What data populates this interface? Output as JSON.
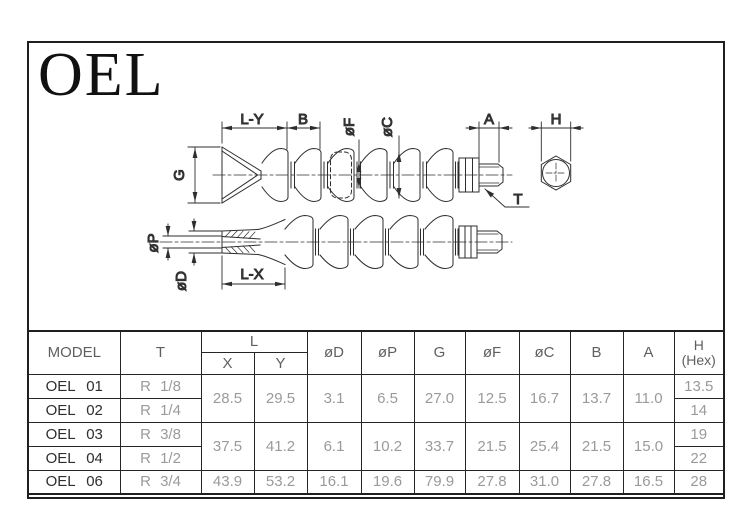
{
  "title": "OEL",
  "drawing": {
    "labels": {
      "ly": "L-Y",
      "b": "B",
      "of": "øF",
      "oc": "øC",
      "a": "A",
      "h": "H",
      "g": "G",
      "t": "T",
      "op": "øP",
      "od": "øD",
      "lx": "L-X"
    }
  },
  "table": {
    "headers": {
      "model": "MODEL",
      "t": "T",
      "l": "L",
      "x": "X",
      "y": "Y",
      "od": "øD",
      "op": "øP",
      "g": "G",
      "of": "øF",
      "oc": "øC",
      "b": "B",
      "a": "A",
      "h1": "H",
      "h2": "(Hex)"
    },
    "rows": [
      {
        "model": "OEL 01",
        "t": "R 1/8",
        "h": "13.5"
      },
      {
        "model": "OEL 02",
        "t": "R 1/4",
        "h": "14"
      },
      {
        "model": "OEL 03",
        "t": "R 3/8",
        "h": "19"
      },
      {
        "model": "OEL 04",
        "t": "R 1/2",
        "h": "22"
      },
      {
        "model": "OEL 06",
        "t": "R 3/4",
        "h": "28"
      }
    ],
    "groups": [
      {
        "x": "28.5",
        "y": "29.5",
        "od": "3.1",
        "op": "6.5",
        "g": "27.0",
        "of": "12.5",
        "oc": "16.7",
        "b": "13.7",
        "a": "11.0"
      },
      {
        "x": "37.5",
        "y": "41.2",
        "od": "6.1",
        "op": "10.2",
        "g": "33.7",
        "of": "21.5",
        "oc": "25.4",
        "b": "21.5",
        "a": "15.0"
      },
      {
        "x": "43.9",
        "y": "53.2",
        "od": "16.1",
        "op": "19.6",
        "g": "79.9",
        "of": "27.8",
        "oc": "31.0",
        "b": "27.8",
        "a": "16.5"
      }
    ]
  },
  "colors": {
    "line": "#2e2e2e",
    "dim_text": "#4a4a4a",
    "frame": "#1f1f1f",
    "value_text": "#9a9a9a",
    "model_text": "#2e2e2e"
  }
}
